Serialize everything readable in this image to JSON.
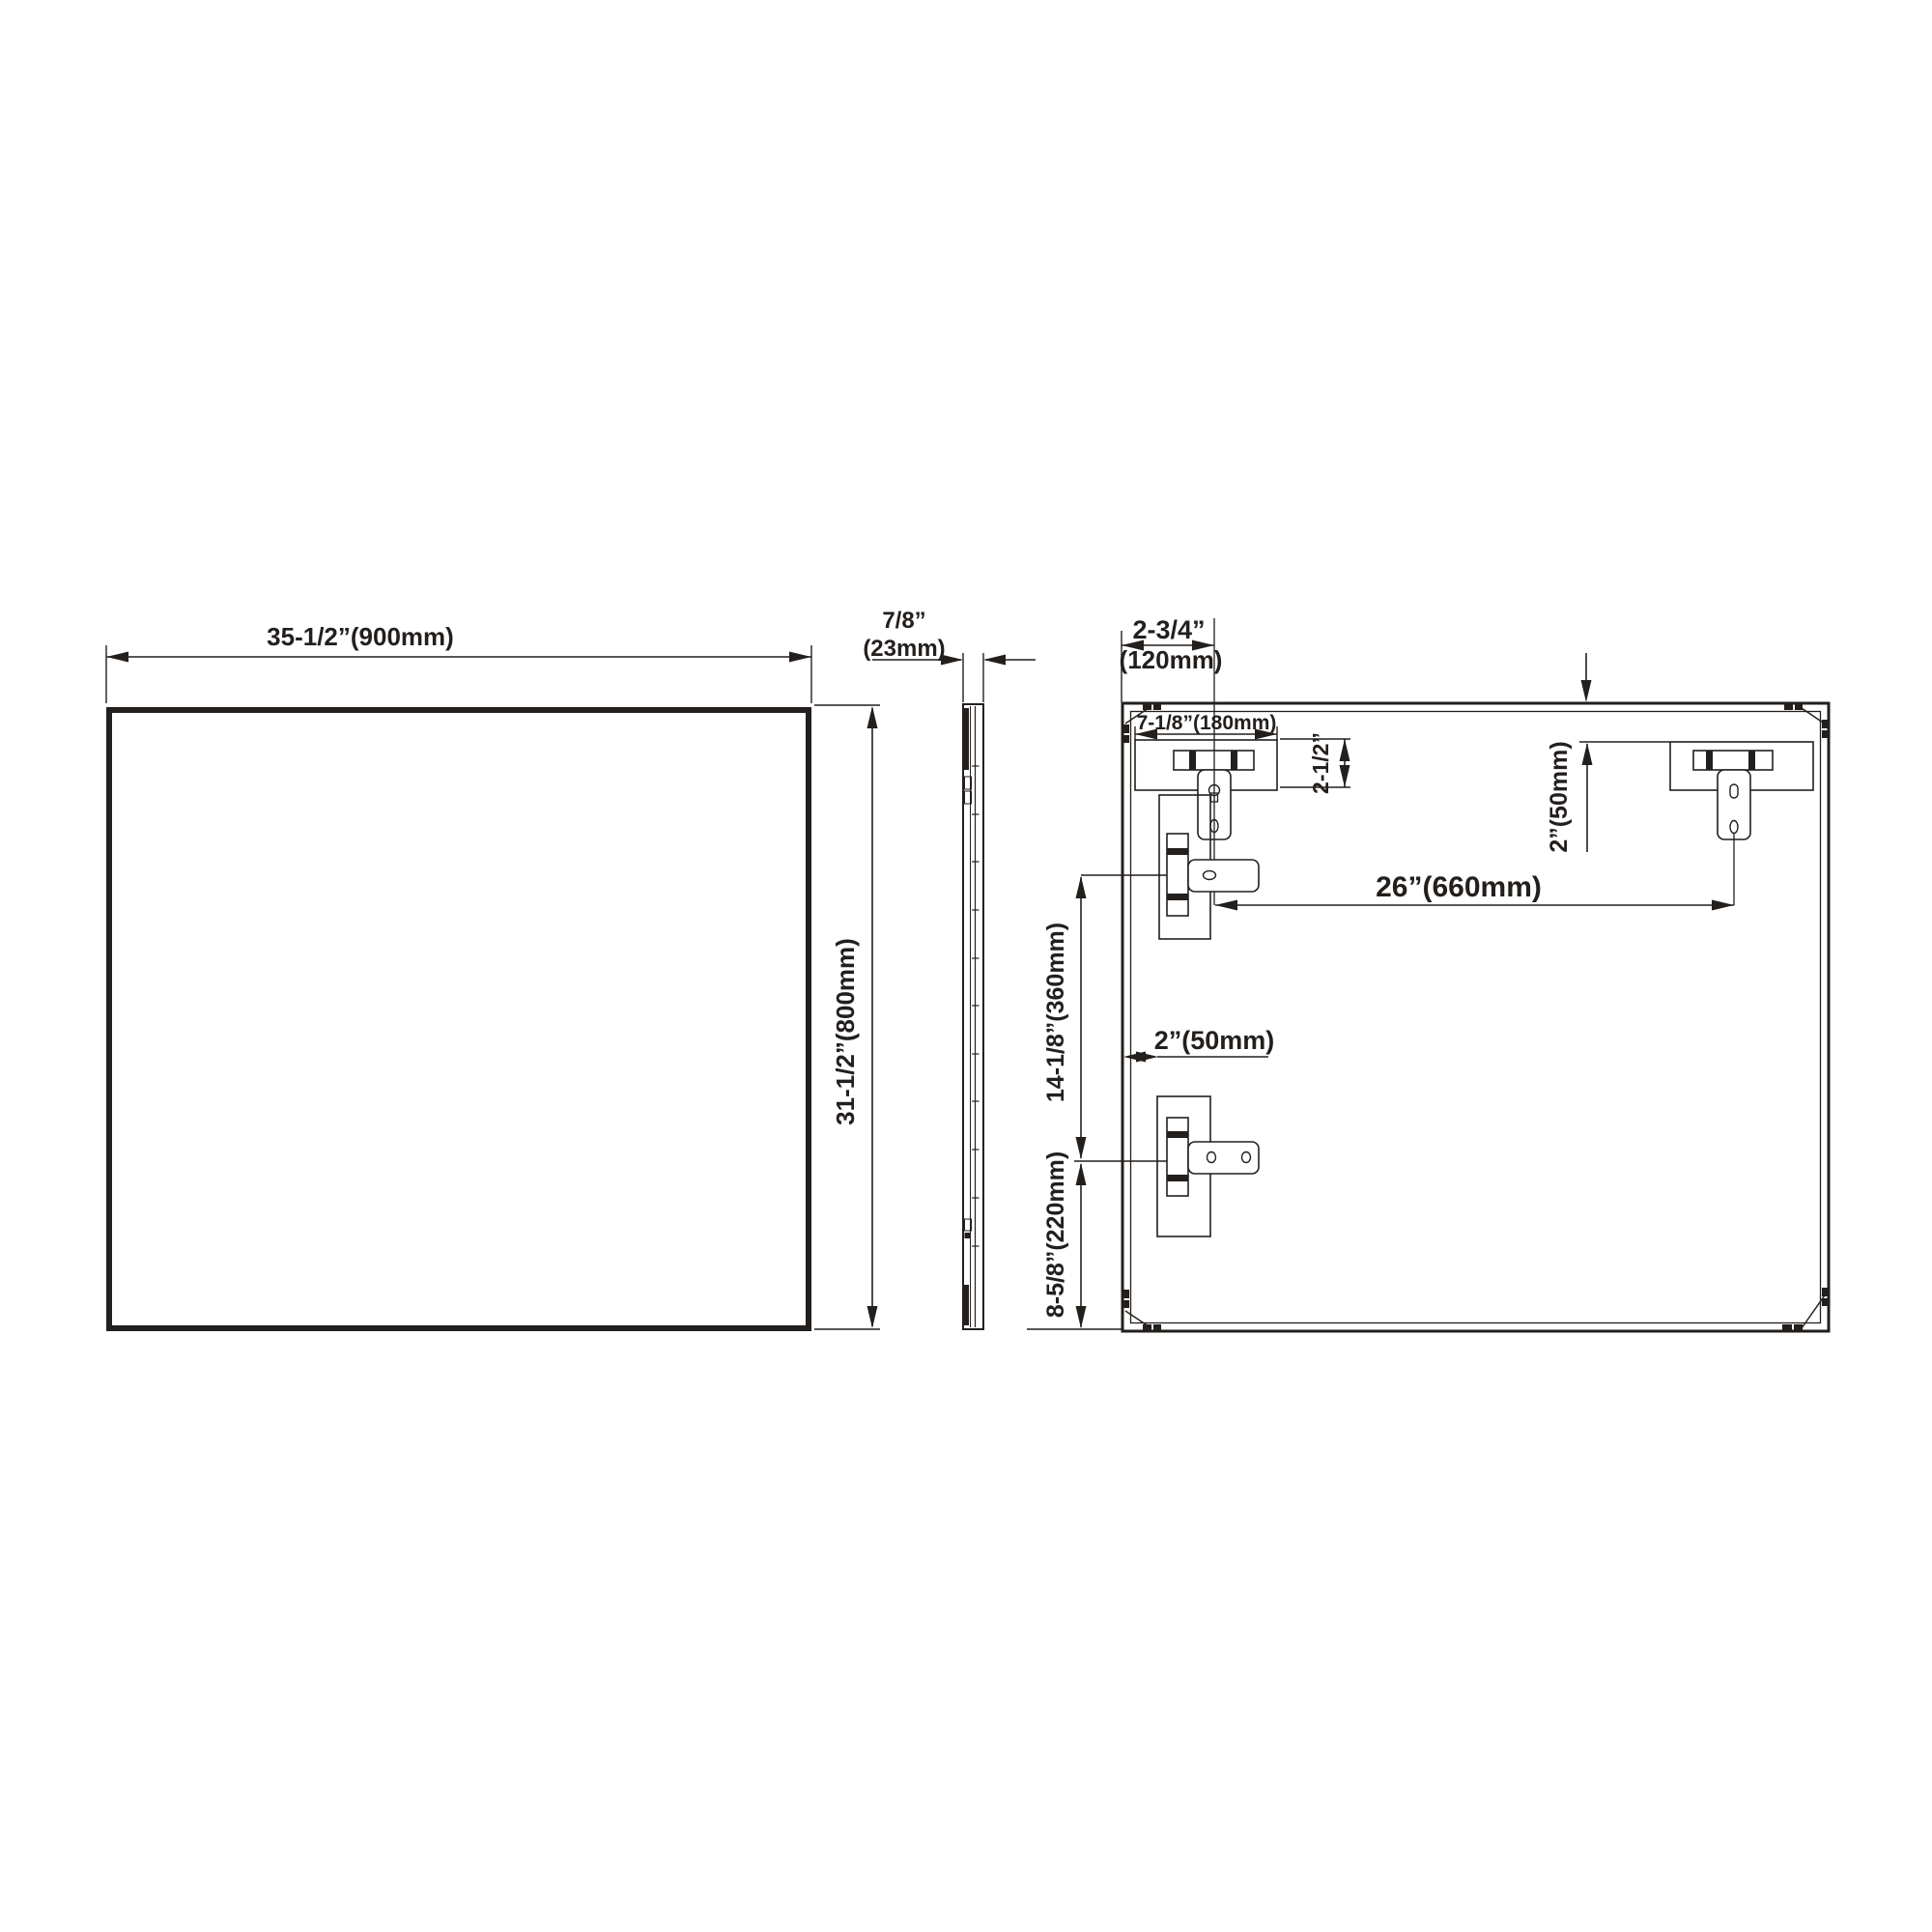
{
  "page": {
    "background": "#ffffff",
    "line_color": "#231f1d",
    "drawing_type": "mirror installation dimension drawing"
  },
  "views": {
    "front": {
      "width_dim": "35-1/2”(900mm)",
      "height_dim": "31-1/2”(800mm)"
    },
    "side": {
      "thickness_in": "7/8”",
      "thickness_mm": "(23mm)"
    },
    "back": {
      "corner_offset_in": "2-3/4”",
      "corner_offset_mm": "(120mm)",
      "cleat_width": "7-1/8”(180mm)",
      "cleat_height": "2-1/2”",
      "top_gap": "2”(50mm)",
      "bracket_spacing": "26”(660mm)",
      "vertical_spacing": "14-1/8”(360mm)",
      "bottom_offset": "8-5/8”(220mm)",
      "side_gap": "2”(50mm)"
    }
  }
}
